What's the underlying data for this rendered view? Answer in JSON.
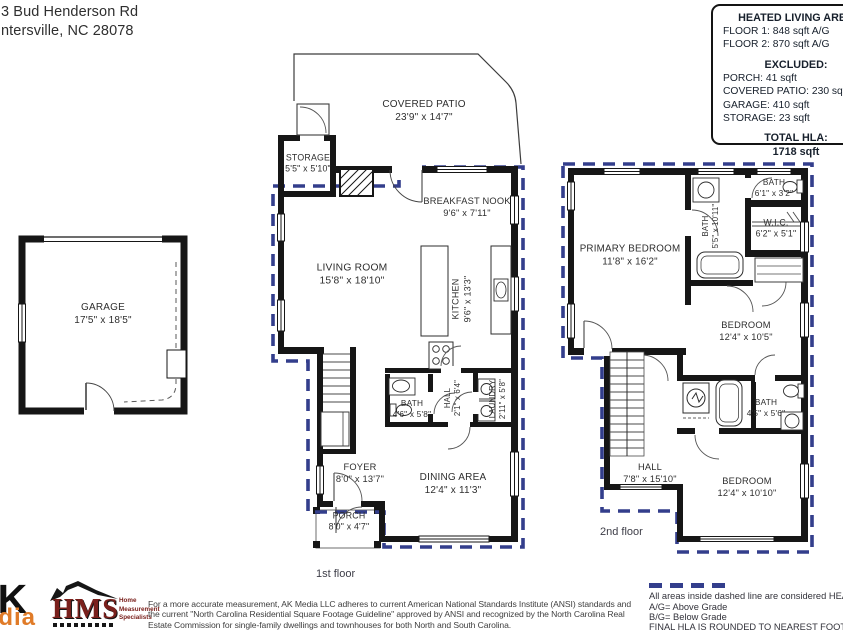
{
  "colors": {
    "wall": "#161616",
    "heated_boundary_dash": "#333e8c",
    "logo_orange": "#e07b28",
    "logo_maroon": "#7a201c"
  },
  "header": {
    "address_line1": "3 Bud Henderson Rd",
    "address_line2": "ntersville, NC  28078"
  },
  "info_box": {
    "title": "HEATED LIVING AREA",
    "floor1": "FLOOR 1: 848 sqft  A/G",
    "floor2": "FLOOR 2: 870 sqft A/G",
    "excluded_title": "EXCLUDED:",
    "excluded_porch": "PORCH: 41 sqft",
    "excluded_patio": "COVERED PATIO: 230 sqft",
    "excluded_garage": "GARAGE: 410 sqft",
    "excluded_storage": "STORAGE: 23 sqft",
    "total_title": "TOTAL HLA:",
    "total_value": "1718 sqft"
  },
  "garage": {
    "name": "GARAGE",
    "dims": "17'5\" x 18'5\""
  },
  "floor1": {
    "caption": "1st floor",
    "rooms": {
      "covered_patio": {
        "name": "COVERED PATIO",
        "dims": "23'9\" x 14'7\""
      },
      "storage": {
        "name": "STORAGE",
        "dims": "5'5\" x 5'10\""
      },
      "breakfast_nook": {
        "name": "BREAKFAST NOOK",
        "dims": "9'6\" x 7'11\""
      },
      "living_room": {
        "name": "LIVING ROOM",
        "dims": "15'8\" x 18'10\""
      },
      "kitchen": {
        "name": "KITCHEN",
        "dims": "9'6\" x 13'3\""
      },
      "bath": {
        "name": "BATH",
        "dims": "4'6\" x 5'8\""
      },
      "hall": {
        "name": "HALL",
        "dims": "2'1\" x 6'4\""
      },
      "laundry": {
        "name": "LAUNDRY",
        "dims": "2'11\" x 5'8\""
      },
      "foyer": {
        "name": "FOYER",
        "dims": "8'0\" x 13'7\""
      },
      "dining_area": {
        "name": "DINING AREA",
        "dims": "12'4\" x 11'3\""
      },
      "porch": {
        "name": "PORCH",
        "dims": "8'0\" x 4'7\""
      }
    }
  },
  "floor2": {
    "caption": "2nd floor",
    "rooms": {
      "primary_bedroom": {
        "name": "PRIMARY BEDROOM",
        "dims": "11'8\" x 16'2\""
      },
      "bath_primary": {
        "name": "BATH",
        "dims": "5'5\" x 10'11\""
      },
      "bath_top": {
        "name": "BATH",
        "dims": "6'1\" x 3'2\""
      },
      "wic": {
        "name": "W.I.C.",
        "dims": "6'2\" x 5'1\""
      },
      "bedroom_mid": {
        "name": "BEDROOM",
        "dims": "12'4\" x 10'5\""
      },
      "hall": {
        "name": "HALL",
        "dims": "7'8\" x 15'10\""
      },
      "bath_lower": {
        "name": "BATH",
        "dims": "4'5\" x 5'6\""
      },
      "bedroom_bottom": {
        "name": "BEDROOM",
        "dims": "12'4\" x 10'10\""
      }
    }
  },
  "legend": {
    "note": "All areas inside dashed line are considered HEATED LIVING",
    "ag": "A/G= Above Grade",
    "bg": "B/G= Below Grade",
    "final": "FINAL HLA IS ROUNDED TO NEAREST FOOT"
  },
  "footer": {
    "ak_logo_top": "AK",
    "ak_logo_bottom": "Media",
    "hms_acronym": "HMS",
    "hms_line1": "Home",
    "hms_line2": "Measurement",
    "hms_line3": "Specialists",
    "disclaimer_line1": "For a more accurate measurement, AK Media LLC adheres to current American National Standards Institute (ANSI) standards and",
    "disclaimer_line2": "the current \"North Carolina Residential Square Footage Guideline\" approved by ANSI and recognized by the North Carolina Real",
    "disclaimer_line3": "Estate Commission for single-family dwellings and townhouses for both North and South Carolina."
  }
}
